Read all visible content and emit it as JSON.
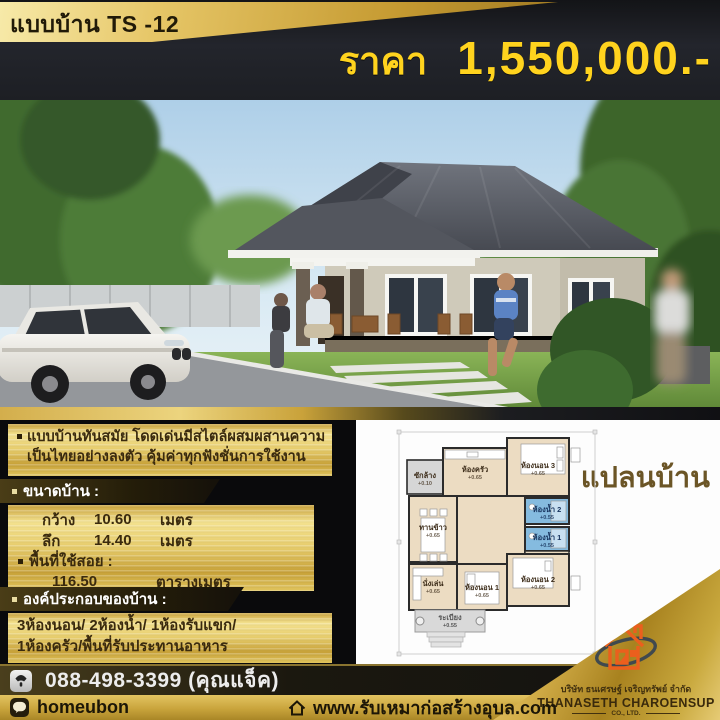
{
  "header": {
    "model": "แบบบ้าน TS -12",
    "price_prefix": "ราคา",
    "price_value": "1,550,000.-"
  },
  "description": {
    "line1": "แบบบ้านทันสมัย โดดเด่นมีสไตล์ผสมผสานความ",
    "line2": "เป็นไทยอย่างลงตัว คุ้มค่าทุกฟังชั่นการใช้งาน"
  },
  "size": {
    "header": "ขนาดบ้าน :",
    "rows": [
      {
        "label": "กว้าง",
        "value": "10.60",
        "unit": "เมตร"
      },
      {
        "label": "ลึก",
        "value": "14.40",
        "unit": "เมตร"
      }
    ],
    "area_label": "พื้นที่ใช้สอย :",
    "area_value": "116.50",
    "area_unit": "ตารางเมตร"
  },
  "components": {
    "header": "องค์ประกอบของบ้าน :",
    "line1": "3ห้องนอน/ 2ห้องน้ำ/ 1ห้องรับแขก/",
    "line2": "1ห้องครัว/พื้นที่รับประทานอาหาร"
  },
  "plan": {
    "title": "แปลนบ้าน",
    "rooms": [
      {
        "name": "ซักล้าง",
        "level": "+0.10"
      },
      {
        "name": "ห้องครัว",
        "level": "+0.65"
      },
      {
        "name": "ห้องนอน 3",
        "level": "+0.65"
      },
      {
        "name": "ทานข้าว",
        "level": "+0.65"
      },
      {
        "name": "ห้องน้ำ 2",
        "level": "+0.55"
      },
      {
        "name": "ห้องน้ำ 1",
        "level": "+0.55"
      },
      {
        "name": "นั่งเล่น",
        "level": "+0.65"
      },
      {
        "name": "ห้องนอน 1",
        "level": "+0.65"
      },
      {
        "name": "ห้องนอน 2",
        "level": "+0.65"
      },
      {
        "name": "ระเบียง",
        "level": "+0.55"
      }
    ]
  },
  "footer": {
    "phone": "088-498-3399 (คุณแจ็ค)",
    "line_id": "homeubon",
    "website": "www.รับเหมาก่อสร้างอุบล.com"
  },
  "company": {
    "thai": "บริษัท ธนเศรษฐ์ เจริญทรัพย์ จำกัด",
    "english": "THANASETH CHAROENSUP",
    "suffix": "CO., LTD."
  },
  "colors": {
    "gold": "#d9b44a",
    "price_text": "#ffd31e",
    "plan_room": "#ecdcc2",
    "bath_blue": "#85bbdf",
    "logo_orange": "#eb5f1d",
    "header_bg": "#23252c"
  }
}
